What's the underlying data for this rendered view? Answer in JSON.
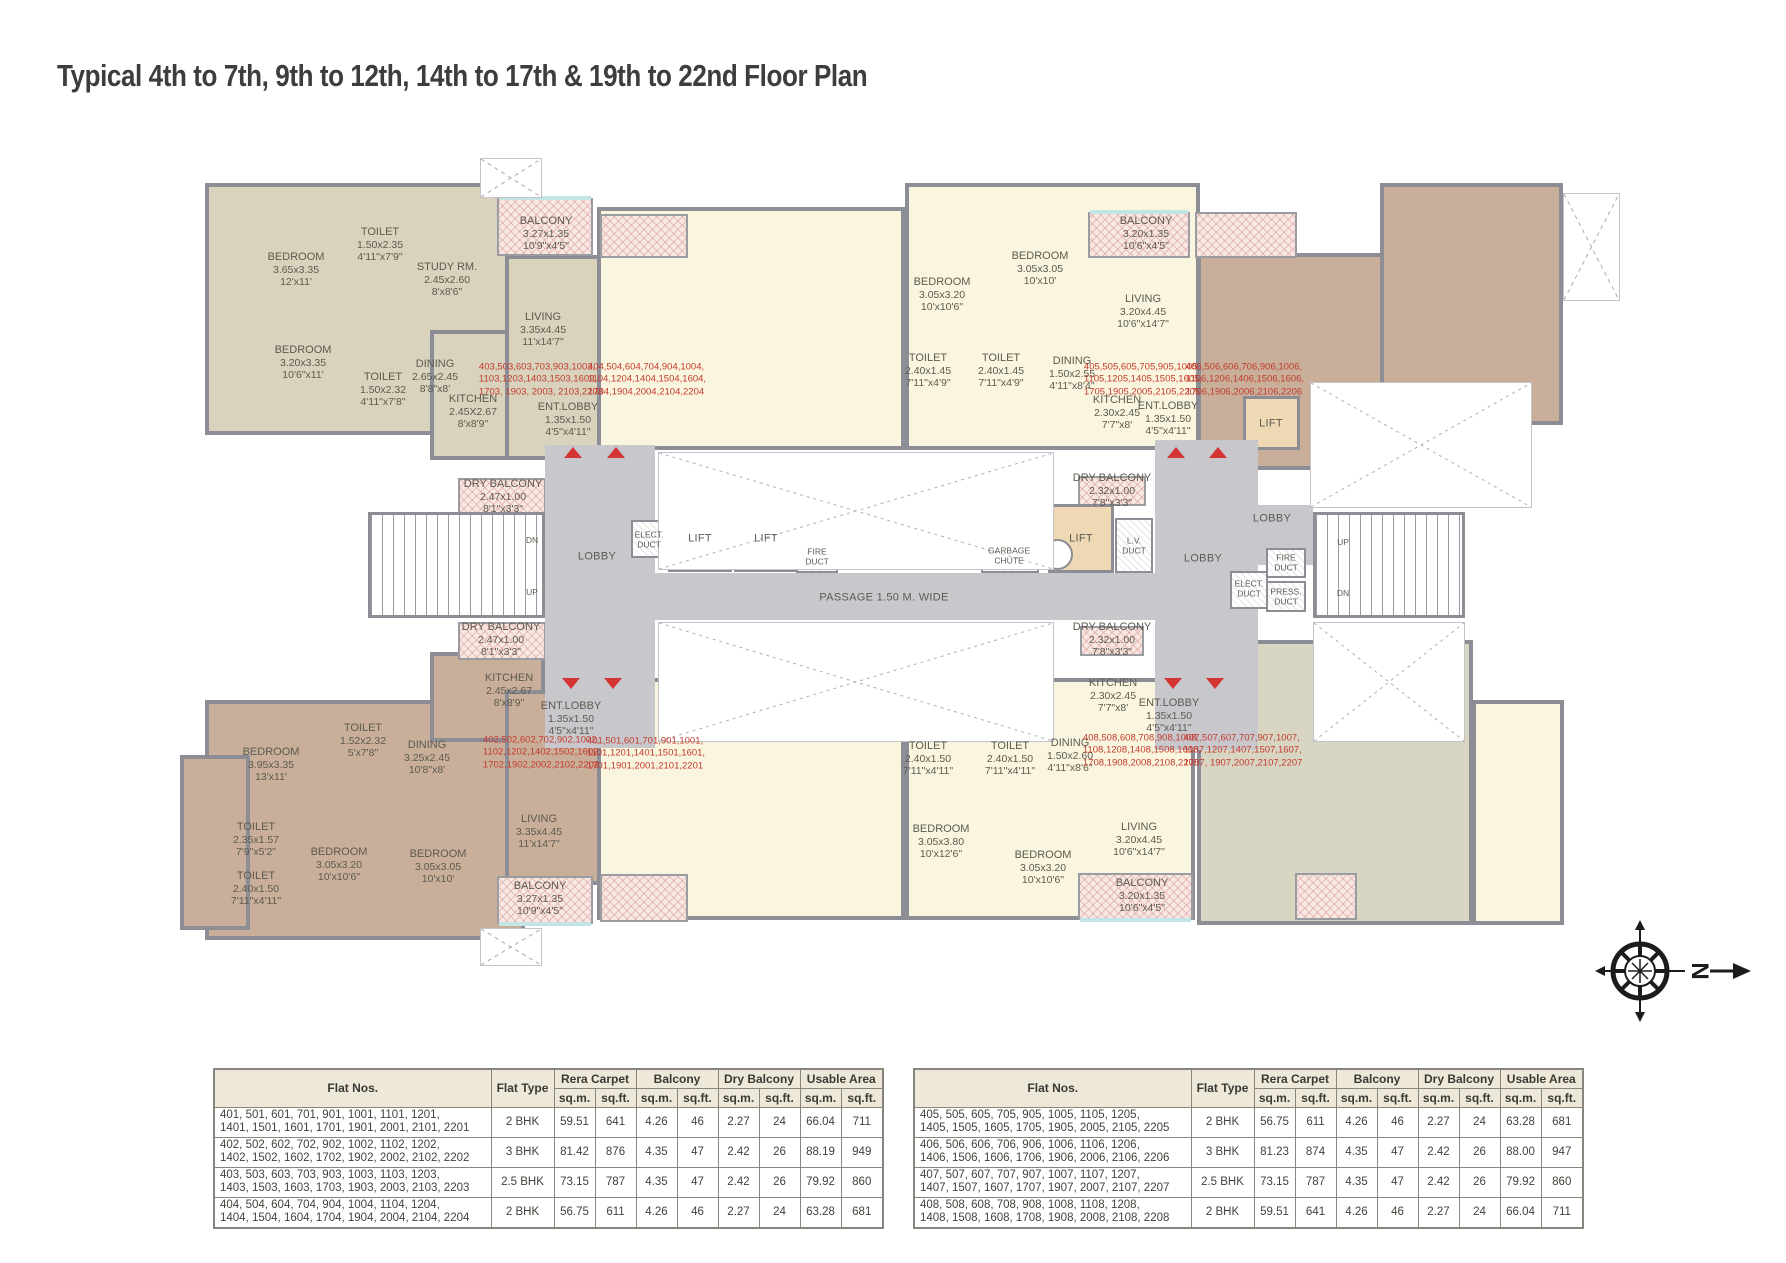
{
  "title": "Typical 4th to 7th, 9th to 12th, 14th to 17th & 19th to 22nd Floor Plan",
  "compass": {
    "north_label": "N"
  },
  "plan": {
    "room_labels": [
      {
        "lines": [
          "BEDROOM",
          "3.65x3.35",
          "12'x11'"
        ],
        "x": 296,
        "y": 270
      },
      {
        "lines": [
          "TOILET",
          "1.50x2.35",
          "4'11\"x7'9\""
        ],
        "x": 380,
        "y": 245
      },
      {
        "lines": [
          "STUDY RM.",
          "2.45x2.60",
          "8'x8'6\""
        ],
        "x": 447,
        "y": 280
      },
      {
        "lines": [
          "BALCONY",
          "3.27x1.35",
          "10'9\"x4'5\""
        ],
        "x": 546,
        "y": 234
      },
      {
        "lines": [
          "LIVING",
          "3.35x4.45",
          "11'x14'7\""
        ],
        "x": 543,
        "y": 330
      },
      {
        "lines": [
          "BEDROOM",
          "3.20x3.35",
          "10'6\"x11'"
        ],
        "x": 303,
        "y": 363
      },
      {
        "lines": [
          "TOILET",
          "1.50x2.32",
          "4'11\"x7'8\""
        ],
        "x": 383,
        "y": 390
      },
      {
        "lines": [
          "DINING",
          "2.65x2.45",
          "8'8\"x8'"
        ],
        "x": 435,
        "y": 377
      },
      {
        "lines": [
          "KITCHEN",
          "2.45X2.67",
          "8'x8'9\""
        ],
        "x": 473,
        "y": 412
      },
      {
        "lines": [
          "ENT.LOBBY",
          "1.35x1.50",
          "4'5\"x4'11\""
        ],
        "x": 568,
        "y": 420
      },
      {
        "lines": [
          "DRY BALCONY",
          "2.47x1.00",
          "8'1\"x3'3\""
        ],
        "x": 503,
        "y": 497
      },
      {
        "lines": [
          "BEDROOM",
          "3.05x3.20",
          "10'x10'6\""
        ],
        "x": 942,
        "y": 295
      },
      {
        "lines": [
          "BEDROOM",
          "3.05x3.05",
          "10'x10'"
        ],
        "x": 1040,
        "y": 269
      },
      {
        "lines": [
          "BALCONY",
          "3.20x1.35",
          "10'6\"x4'5\""
        ],
        "x": 1146,
        "y": 234
      },
      {
        "lines": [
          "LIVING",
          "3.20x4.45",
          "10'6\"x14'7\""
        ],
        "x": 1143,
        "y": 312
      },
      {
        "lines": [
          "TOILET",
          "2.40x1.45",
          "7'11\"x4'9\""
        ],
        "x": 928,
        "y": 371
      },
      {
        "lines": [
          "TOILET",
          "2.40x1.45",
          "7'11\"x4'9\""
        ],
        "x": 1001,
        "y": 371
      },
      {
        "lines": [
          "DINING",
          "1.50x2.55",
          "4'11\"x8'4\""
        ],
        "x": 1072,
        "y": 374
      },
      {
        "lines": [
          "KITCHEN",
          "2.30x2.45",
          "7'7\"x8'"
        ],
        "x": 1117,
        "y": 413
      },
      {
        "lines": [
          "ENT.LOBBY",
          "1.35x1.50",
          "4'5\"x4'11\""
        ],
        "x": 1168,
        "y": 419
      },
      {
        "lines": [
          "DRY BALCONY",
          "2.32x1.00",
          "7'8\"x3'3\""
        ],
        "x": 1112,
        "y": 491
      },
      {
        "lines": [
          "DRY BALCONY",
          "2.47x1.00",
          "8'1\"x3'3\""
        ],
        "x": 501,
        "y": 640
      },
      {
        "lines": [
          "KITCHEN",
          "2.45x2.67",
          "8'x8'9\""
        ],
        "x": 509,
        "y": 691
      },
      {
        "lines": [
          "ENT.LOBBY",
          "1.35x1.50",
          "4'5\"x4'11\""
        ],
        "x": 571,
        "y": 719
      },
      {
        "lines": [
          "TOILET",
          "1.52x2.32",
          "5'x7'8\""
        ],
        "x": 363,
        "y": 741
      },
      {
        "lines": [
          "DINING",
          "3.25x2.45",
          "10'8\"x8'"
        ],
        "x": 427,
        "y": 758
      },
      {
        "lines": [
          "BEDROOM",
          "3.95x3.35",
          "13'x11'"
        ],
        "x": 271,
        "y": 765
      },
      {
        "lines": [
          "TOILET",
          "2.35x1.57",
          "7'9\"x5'2\""
        ],
        "x": 256,
        "y": 840
      },
      {
        "lines": [
          "TOILET",
          "2.40x1.50",
          "7'11\"x4'11\""
        ],
        "x": 256,
        "y": 889
      },
      {
        "lines": [
          "BEDROOM",
          "3.05x3.20",
          "10'x10'6\""
        ],
        "x": 339,
        "y": 865
      },
      {
        "lines": [
          "BEDROOM",
          "3.05x3.05",
          "10'x10'"
        ],
        "x": 438,
        "y": 867
      },
      {
        "lines": [
          "LIVING",
          "3.35x4.45",
          "11'x14'7\""
        ],
        "x": 539,
        "y": 832
      },
      {
        "lines": [
          "BALCONY",
          "3.27x1.35",
          "10'9\"x4'5\""
        ],
        "x": 540,
        "y": 899
      },
      {
        "lines": [
          "TOILET",
          "2.40x1.50",
          "7'11\"x4'11\""
        ],
        "x": 928,
        "y": 759
      },
      {
        "lines": [
          "TOILET",
          "2.40x1.50",
          "7'11\"x4'11\""
        ],
        "x": 1010,
        "y": 759
      },
      {
        "lines": [
          "DINING",
          "1.50x2.60",
          "4'11\"x8'6\""
        ],
        "x": 1070,
        "y": 756
      },
      {
        "lines": [
          "DRY BALCONY",
          "2.32x1.00",
          "7'8\"x3'3\""
        ],
        "x": 1112,
        "y": 640
      },
      {
        "lines": [
          "KITCHEN",
          "2.30x2.45",
          "7'7\"x8'"
        ],
        "x": 1113,
        "y": 696
      },
      {
        "lines": [
          "ENT.LOBBY",
          "1.35x1.50",
          "4'5\"x4'11\""
        ],
        "x": 1169,
        "y": 716
      },
      {
        "lines": [
          "BEDROOM",
          "3.05x3.80",
          "10'x12'6\""
        ],
        "x": 941,
        "y": 842
      },
      {
        "lines": [
          "BEDROOM",
          "3.05x3.20",
          "10'x10'6\""
        ],
        "x": 1043,
        "y": 868
      },
      {
        "lines": [
          "LIVING",
          "3.20x4.45",
          "10'6\"x14'7\""
        ],
        "x": 1139,
        "y": 840
      },
      {
        "lines": [
          "BALCONY",
          "3.20x1.35",
          "10'6\"x4'5\""
        ],
        "x": 1142,
        "y": 896
      }
    ],
    "flat_labels": [
      {
        "lines": [
          "403,503,603,703,903,1003,",
          "1103,1203,1403,1503,1603,",
          "1703, 1903, 2003, 2103,2203"
        ],
        "x": 541,
        "y": 380
      },
      {
        "lines": [
          "404,504,604,704,904,1004,",
          "1104,1204,1404,1504,1604,",
          "1704,1904,2004,2104,2204"
        ],
        "x": 647,
        "y": 380
      },
      {
        "lines": [
          "405,505,605,705,905,1005,",
          "1105,1205,1405,1505,1605,",
          "1705,1905,2005,2105,2205"
        ],
        "x": 1143,
        "y": 380
      },
      {
        "lines": [
          "406,506,606,706,906,1006,",
          "1106,1206,1406,1506,1606,",
          "1706,1906,2006,2106,2206"
        ],
        "x": 1245,
        "y": 380
      },
      {
        "lines": [
          "402,502,602,702,902,1002,",
          "1102,1202,1402,1502,1602,",
          "1702,1902,2002,2102,2202"
        ],
        "x": 542,
        "y": 753
      },
      {
        "lines": [
          "401,501,601,701,901,1001,",
          "1101,1201,1401,1501,1601,",
          "1701,1901,2001,2101,2201"
        ],
        "x": 646,
        "y": 754
      },
      {
        "lines": [
          "408,508,608,708,908,1008,",
          "1108,1208,1408,1508,1608,",
          "1708,1908,2008,2108,2208"
        ],
        "x": 1142,
        "y": 751
      },
      {
        "lines": [
          "407,507,607,707,907,1007,",
          "1107,1207,1407,1507,1607,",
          "1707, 1907,2007,2107,2207"
        ],
        "x": 1243,
        "y": 751
      }
    ],
    "small_labels": [
      {
        "lines": [
          "LOBBY"
        ],
        "x": 597,
        "y": 557,
        "cls": "mid"
      },
      {
        "lines": [
          "LOBBY"
        ],
        "x": 1203,
        "y": 559,
        "cls": "mid"
      },
      {
        "lines": [
          "LOBBY"
        ],
        "x": 1272,
        "y": 519,
        "cls": "mid"
      },
      {
        "lines": [
          "PASSAGE 1.50 M. WIDE"
        ],
        "x": 884,
        "y": 598,
        "cls": "mid"
      },
      {
        "lines": [
          "LIFT"
        ],
        "x": 700,
        "y": 539,
        "cls": "mid"
      },
      {
        "lines": [
          "LIFT"
        ],
        "x": 766,
        "y": 539,
        "cls": "mid"
      },
      {
        "lines": [
          "LIFT"
        ],
        "x": 1081,
        "y": 539,
        "cls": "mid"
      },
      {
        "lines": [
          "LIFT"
        ],
        "x": 1271,
        "y": 424,
        "cls": "mid"
      },
      {
        "lines": [
          "DN"
        ],
        "x": 532,
        "y": 541,
        "cls": "tiny"
      },
      {
        "lines": [
          "UP"
        ],
        "x": 532,
        "y": 593,
        "cls": "tiny"
      },
      {
        "lines": [
          "UP"
        ],
        "x": 1343,
        "y": 543,
        "cls": "tiny"
      },
      {
        "lines": [
          "DN"
        ],
        "x": 1343,
        "y": 594,
        "cls": "tiny"
      },
      {
        "lines": [
          "ELECT.",
          "DUCT"
        ],
        "x": 649,
        "y": 540,
        "cls": "tiny"
      },
      {
        "lines": [
          "FIRE",
          "DUCT"
        ],
        "x": 817,
        "y": 557,
        "cls": "tiny"
      },
      {
        "lines": [
          "GARBAGE",
          "CHUTE"
        ],
        "x": 1009,
        "y": 556,
        "cls": "tiny"
      },
      {
        "lines": [
          "L.V.",
          "DUCT"
        ],
        "x": 1134,
        "y": 546,
        "cls": "tiny"
      },
      {
        "lines": [
          "FIRE",
          "DUCT"
        ],
        "x": 1286,
        "y": 563,
        "cls": "tiny"
      },
      {
        "lines": [
          "ELECT.",
          "DUCT"
        ],
        "x": 1249,
        "y": 589,
        "cls": "tiny"
      },
      {
        "lines": [
          "PRESS.",
          "DUCT"
        ],
        "x": 1286,
        "y": 597,
        "cls": "tiny"
      }
    ]
  },
  "tables": [
    {
      "headers": {
        "flat_nos": "Flat Nos.",
        "flat_type": "Flat Type",
        "groups": [
          "Rera Carpet",
          "Balcony",
          "Dry Balcony",
          "Usable Area"
        ],
        "sub_units": [
          "sq.m.",
          "sq.ft."
        ]
      },
      "rows": [
        {
          "flats": [
            "401, 501, 601, 701, 901, 1001, 1101, 1201,",
            "1401, 1501, 1601, 1701, 1901, 2001, 2101, 2201"
          ],
          "type": "2 BHK",
          "values": [
            "59.51",
            "641",
            "4.26",
            "46",
            "2.27",
            "24",
            "66.04",
            "711"
          ]
        },
        {
          "flats": [
            "402, 502, 602, 702, 902, 1002, 1102, 1202,",
            "1402, 1502, 1602, 1702, 1902, 2002, 2102, 2202"
          ],
          "type": "3 BHK",
          "values": [
            "81.42",
            "876",
            "4.35",
            "47",
            "2.42",
            "26",
            "88.19",
            "949"
          ]
        },
        {
          "flats": [
            "403, 503, 603, 703, 903, 1003, 1103, 1203,",
            "1403, 1503, 1603, 1703, 1903, 2003, 2103, 2203"
          ],
          "type": "2.5 BHK",
          "values": [
            "73.15",
            "787",
            "4.35",
            "47",
            "2.42",
            "26",
            "79.92",
            "860"
          ]
        },
        {
          "flats": [
            "404, 504, 604, 704, 904, 1004, 1104, 1204,",
            "1404, 1504, 1604, 1704, 1904, 2004, 2104, 2204"
          ],
          "type": "2 BHK",
          "values": [
            "56.75",
            "611",
            "4.26",
            "46",
            "2.27",
            "24",
            "63.28",
            "681"
          ]
        }
      ]
    },
    {
      "headers": {
        "flat_nos": "Flat Nos.",
        "flat_type": "Flat Type",
        "groups": [
          "Rera Carpet",
          "Balcony",
          "Dry Balcony",
          "Usable Area"
        ],
        "sub_units": [
          "sq.m.",
          "sq.ft."
        ]
      },
      "rows": [
        {
          "flats": [
            "405, 505, 605, 705, 905, 1005, 1105, 1205,",
            "1405, 1505, 1605, 1705, 1905, 2005, 2105, 2205"
          ],
          "type": "2 BHK",
          "values": [
            "56.75",
            "611",
            "4.26",
            "46",
            "2.27",
            "24",
            "63.28",
            "681"
          ]
        },
        {
          "flats": [
            "406, 506, 606, 706, 906, 1006, 1106, 1206,",
            "1406, 1506, 1606, 1706, 1906, 2006, 2106, 2206"
          ],
          "type": "3 BHK",
          "values": [
            "81.23",
            "874",
            "4.35",
            "47",
            "2.42",
            "26",
            "88.00",
            "947"
          ]
        },
        {
          "flats": [
            "407, 507, 607, 707, 907, 1007, 1107, 1207,",
            "1407, 1507, 1607, 1707, 1907, 2007, 2107, 2207"
          ],
          "type": "2.5 BHK",
          "values": [
            "73.15",
            "787",
            "4.35",
            "47",
            "2.42",
            "26",
            "79.92",
            "860"
          ]
        },
        {
          "flats": [
            "408, 508, 608, 708, 908, 1008, 1108, 1208,",
            "1408, 1508, 1608, 1708, 1908, 2008, 2108, 2208"
          ],
          "type": "2 BHK",
          "values": [
            "59.51",
            "641",
            "4.26",
            "46",
            "2.27",
            "24",
            "66.04",
            "711"
          ]
        }
      ]
    }
  ]
}
